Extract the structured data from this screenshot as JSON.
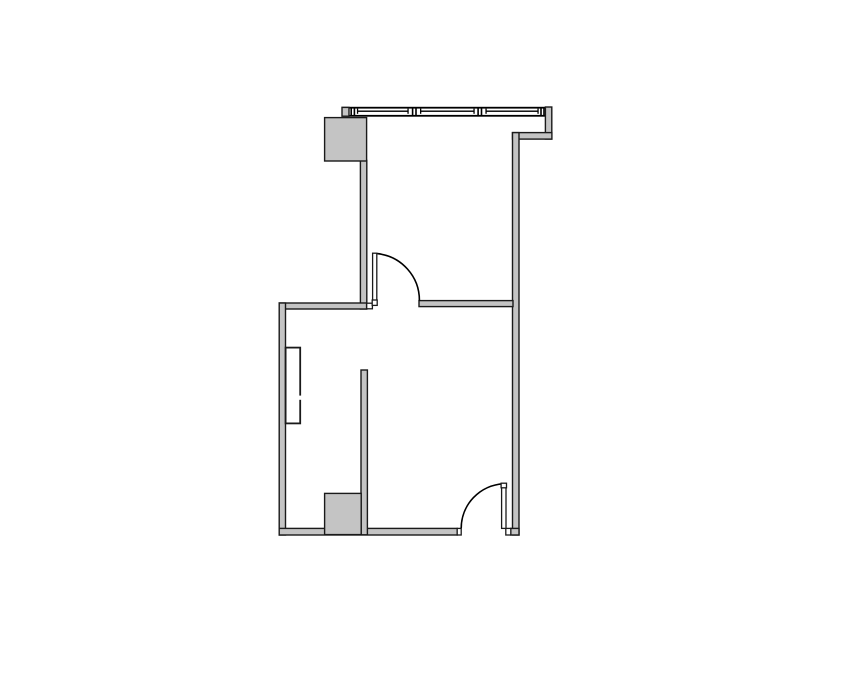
{
  "colors": {
    "background": "#ffffff",
    "wall_fill": "#c4c4c4",
    "wall_outline": "#1a1a1a",
    "line_color": "#000000"
  },
  "plan": {
    "kind": "architectural-floor-plan",
    "features": [
      {
        "name": "window-wall",
        "type": "exterior curtain wall with mullions",
        "mullion_sections": 3
      },
      {
        "name": "column-upper-left",
        "type": "structural column"
      },
      {
        "name": "column-lower-left",
        "type": "structural column"
      },
      {
        "name": "door-upper",
        "type": "swing door",
        "state": "open, quarter-circle swing arc"
      },
      {
        "name": "door-lower",
        "type": "swing door",
        "state": "open, quarter-circle swing arc"
      },
      {
        "name": "wall-recess-left",
        "type": "recessed fixture in left wall, split in two panels"
      },
      {
        "name": "room-upper",
        "type": "room"
      },
      {
        "name": "room-lower",
        "type": "room"
      }
    ]
  }
}
